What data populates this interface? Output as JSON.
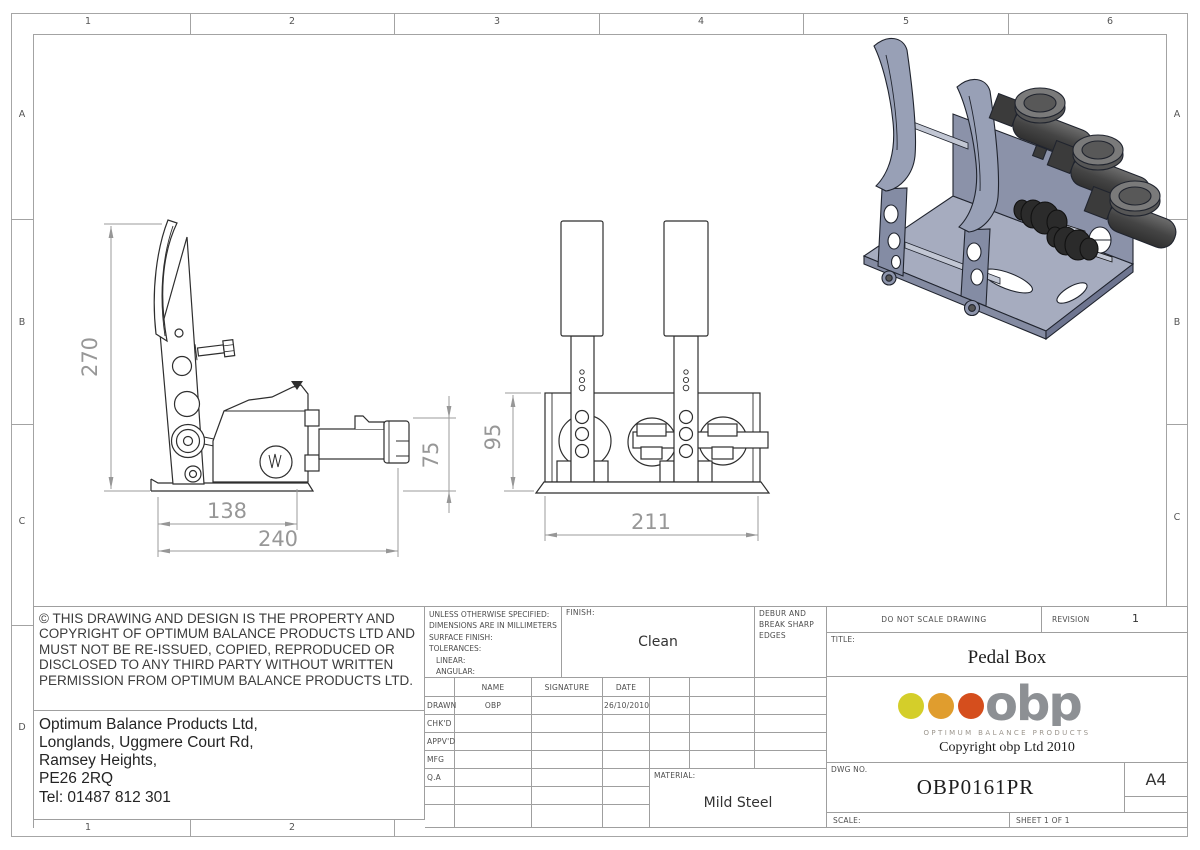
{
  "sheet": {
    "border": {
      "cols": [
        "1",
        "2",
        "3",
        "4",
        "5",
        "6"
      ],
      "rows": [
        "A",
        "B",
        "C",
        "D"
      ]
    },
    "dims": {
      "side_height": "270",
      "side_pad_depth": "138",
      "side_total_depth": "240",
      "side_cyl_height": "75",
      "front_box_height": "95",
      "front_box_width": "211"
    },
    "notice": "© THIS DRAWING AND DESIGN IS THE PROPERTY AND COPYRIGHT OF OPTIMUM BALANCE PRODUCTS LTD AND MUST NOT BE RE-ISSUED, COPIED, REPRODUCED OR DISCLOSED TO ANY THIRD PARTY WITHOUT WRITTEN PERMISSION FROM OPTIMUM BALANCE PRODUCTS LTD.",
    "address": [
      "Optimum Balance Products Ltd,",
      "Longlands, Uggmere Court Rd,",
      "Ramsey Heights,",
      "PE26 2RQ",
      "Tel: 01487 812 301"
    ],
    "spec_lines": [
      "UNLESS OTHERWISE SPECIFIED:",
      "DIMENSIONS ARE IN MILLIMETERS",
      "SURFACE FINISH:",
      "TOLERANCES:",
      "LINEAR:",
      "ANGULAR:"
    ],
    "finish_label": "FINISH:",
    "finish_value": "Clean",
    "debur": "DEBUR AND BREAK SHARP EDGES",
    "approval": {
      "headers": [
        "NAME",
        "SIGNATURE",
        "DATE"
      ],
      "rows": [
        {
          "label": "DRAWN",
          "name": "OBP",
          "signature": "",
          "date": "26/10/2010"
        },
        {
          "label": "CHK'D",
          "name": "",
          "signature": "",
          "date": ""
        },
        {
          "label": "APPV'D",
          "name": "",
          "signature": "",
          "date": ""
        },
        {
          "label": "MFG",
          "name": "",
          "signature": "",
          "date": ""
        },
        {
          "label": "Q.A",
          "name": "",
          "signature": "",
          "date": ""
        }
      ]
    },
    "material_label": "MATERIAL:",
    "material_value": "Mild Steel",
    "do_not_scale": "DO NOT SCALE DRAWING",
    "revision_label": "REVISION",
    "revision_value": "1",
    "title_label": "TITLE:",
    "title_value": "Pedal Box",
    "dwg_label": "DWG NO.",
    "dwg_value": "OBP0161PR",
    "paper_size": "A4",
    "scale_label": "SCALE:",
    "sheet_label": "SHEET 1 OF 1",
    "logo": {
      "word": "obp",
      "tagline": "OPTIMUM BALANCE PRODUCTS",
      "copyright": "Copyright obp Ltd 2010",
      "dot_colors": [
        "#d4ce2a",
        "#e09d2e",
        "#d54e1d"
      ],
      "word_color": "#8d9094"
    }
  }
}
